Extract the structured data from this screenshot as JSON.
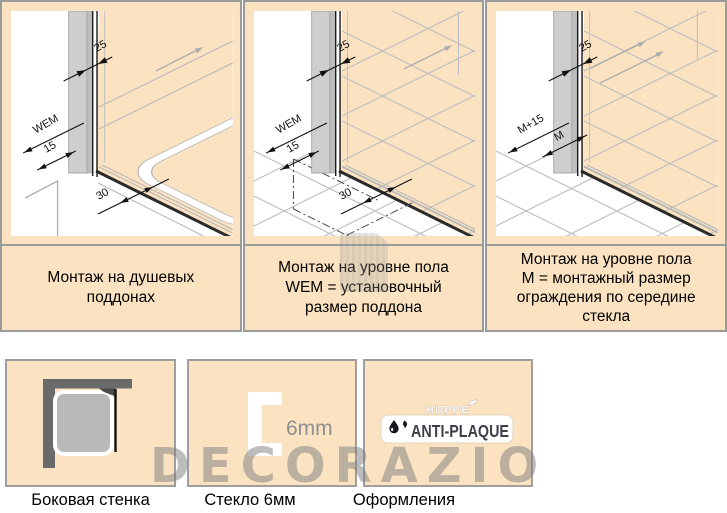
{
  "colors": {
    "peach": "#fbe3c2",
    "border_gray": "#9b9b9b",
    "drawing_gray": "#b5b5b5",
    "dark_line": "#1a1a1a",
    "wall_gray": "#6a6a6a",
    "tray_gray": "#b9b9b9",
    "logo_dark": "#3f3f49"
  },
  "top_panels": [
    {
      "caption_lines": [
        "Монтаж на душевых",
        "поддонах"
      ],
      "dims": {
        "top": "25",
        "upper": "WEM",
        "lower": "15",
        "rim": "30"
      }
    },
    {
      "caption_lines": [
        "Монтаж на уровне пола",
        "WEM = установочный",
        "размер поддона"
      ],
      "dims": {
        "top": "25",
        "upper": "WEM",
        "lower": "15",
        "rim": "30"
      }
    },
    {
      "caption_lines": [
        "Монтаж на уровне пола",
        "М = монтажный размер",
        "ограждения по середине",
        "стекла"
      ],
      "dims": {
        "top": "25",
        "upper": "M+15",
        "lower": "M"
      }
    }
  ],
  "bottom_panels": [
    {
      "caption": "Боковая стенка"
    },
    {
      "caption": "Стекло 6мм",
      "glass_label": "6mm"
    },
    {
      "caption": "Оформления",
      "brand": "HUPPE",
      "logo": "ANTI-PLAQUE"
    }
  ],
  "watermark": {
    "text": "DECORAZIO"
  }
}
